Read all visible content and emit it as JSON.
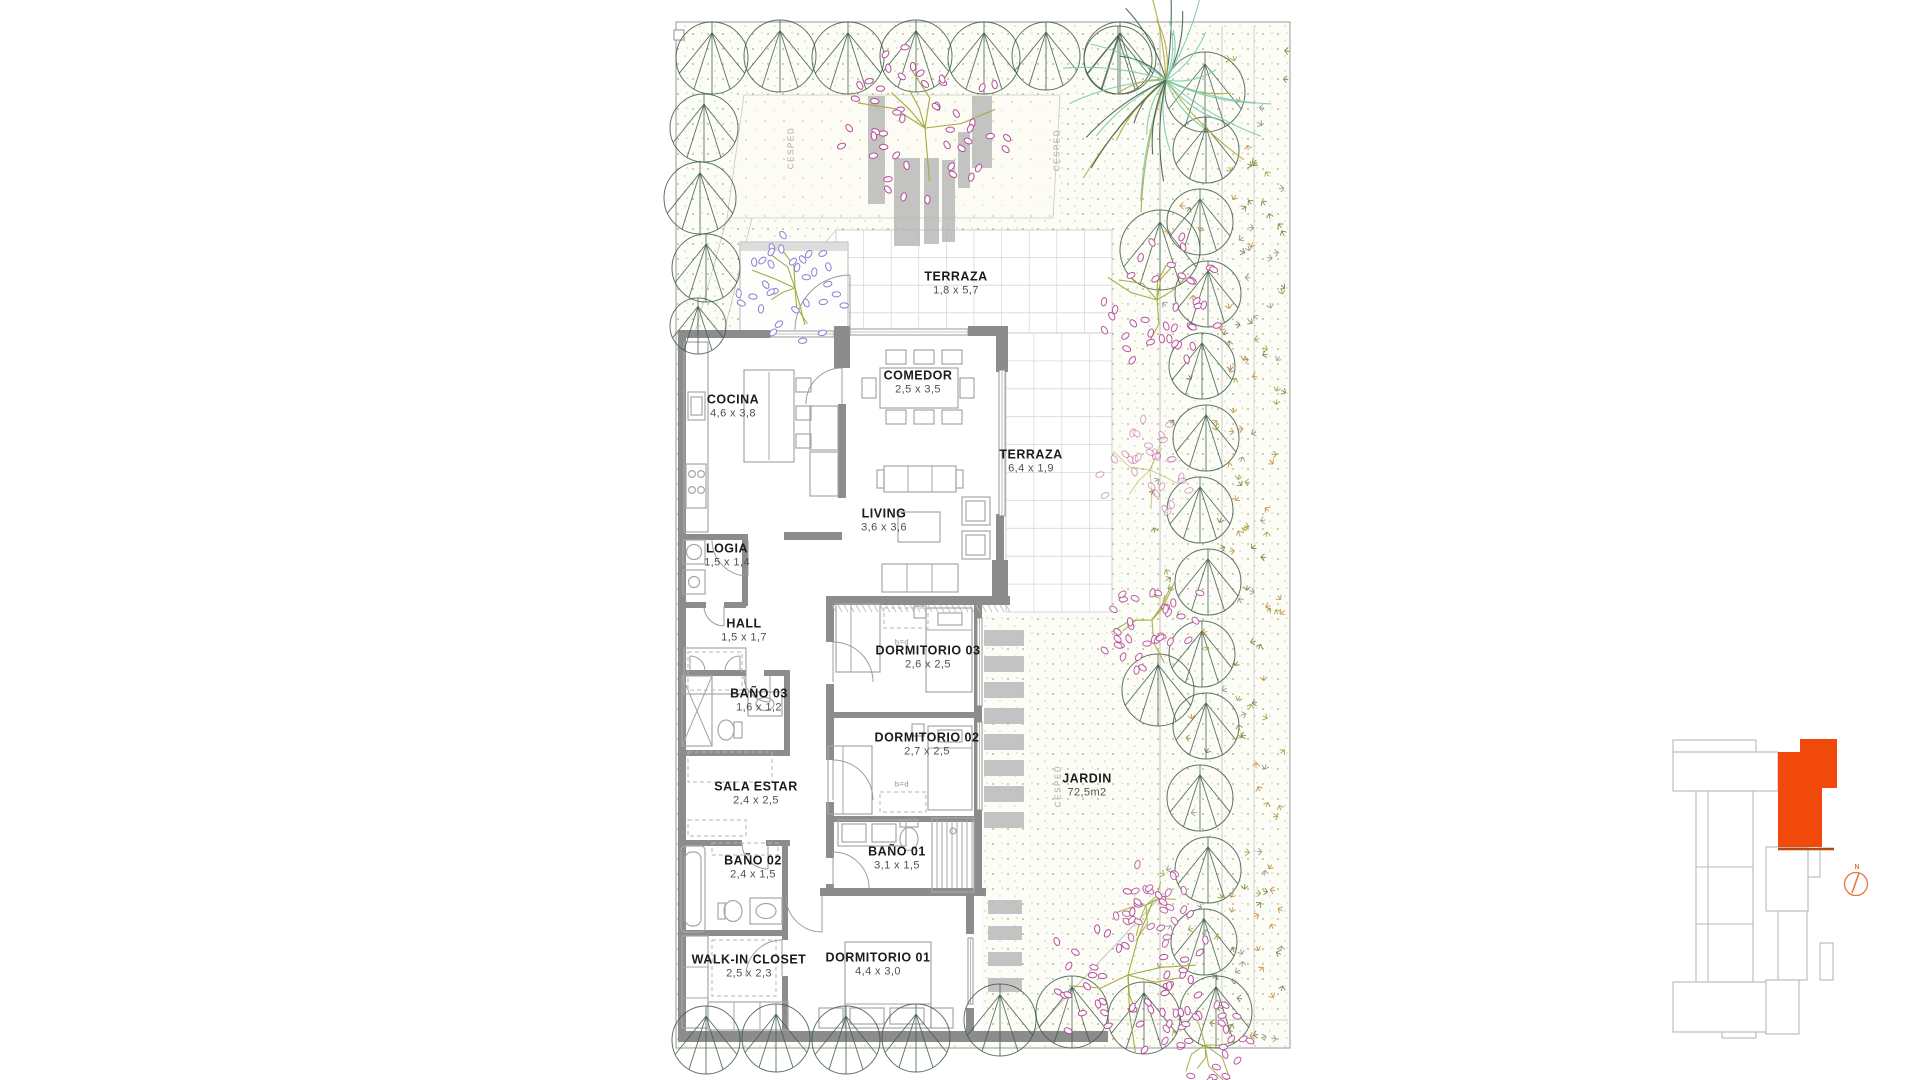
{
  "page": {
    "background": "#ffffff"
  },
  "plan": {
    "rooms": [
      {
        "name": "TERRAZA",
        "dims": "1,8 x 5,7",
        "x": 956,
        "y": 283
      },
      {
        "name": "COCINA",
        "dims": "4,6 x 3,8",
        "x": 733,
        "y": 406
      },
      {
        "name": "COMEDOR",
        "dims": "2,5 x 3,5",
        "x": 918,
        "y": 382
      },
      {
        "name": "TERRAZA",
        "dims": "6,4 x 1,9",
        "x": 1031,
        "y": 461
      },
      {
        "name": "LIVING",
        "dims": "3,6 x 3,6",
        "x": 884,
        "y": 520
      },
      {
        "name": "LOGIA",
        "dims": "1,5 x 1,4",
        "x": 727,
        "y": 555
      },
      {
        "name": "HALL",
        "dims": "1,5 x 1,7",
        "x": 744,
        "y": 630
      },
      {
        "name": "BAÑO 03",
        "dims": "1,6 x 1,2",
        "x": 759,
        "y": 700
      },
      {
        "name": "DORMITORIO 03",
        "dims": "2,6 x 2,5",
        "x": 928,
        "y": 657
      },
      {
        "name": "DORMITORIO 02",
        "dims": "2,7 x 2,5",
        "x": 927,
        "y": 744
      },
      {
        "name": "SALA ESTAR",
        "dims": "2,4 x 2,5",
        "x": 756,
        "y": 793
      },
      {
        "name": "BAÑO 02",
        "dims": "2,4 x 1,5",
        "x": 753,
        "y": 867
      },
      {
        "name": "BAÑO 01",
        "dims": "3,1 x 1,5",
        "x": 897,
        "y": 858
      },
      {
        "name": "JARDIN",
        "dims": "72,5m2",
        "x": 1087,
        "y": 785
      },
      {
        "name": "WALK-IN CLOSET",
        "dims": "2,5 x 2,3",
        "x": 749,
        "y": 966
      },
      {
        "name": "DORMITORIO 01",
        "dims": "4,4 x 3,0",
        "x": 878,
        "y": 964
      }
    ],
    "ground_labels": [
      {
        "text": "CESPED",
        "x": 791,
        "y": 148
      },
      {
        "text": "CESPED",
        "x": 1057,
        "y": 150
      },
      {
        "text": "CESPED",
        "x": 1058,
        "y": 786
      }
    ],
    "furniture_markers": [
      {
        "text": "b=d",
        "x": 902,
        "y": 642
      },
      {
        "text": "b=d",
        "x": 902,
        "y": 784
      }
    ]
  },
  "keyplan": {
    "unit_color": "#F1490B",
    "unit_underline_color": "#B5490F",
    "outline_color": "#B9B9B9",
    "compass": {
      "label": "N",
      "color": "#E4763B"
    }
  },
  "palette": {
    "wall": "#8C8C8C",
    "furniture_line": "#A6A6A6",
    "dashed_line": "#B5B5B5",
    "tile_line": "#D8D8D8",
    "tile_border": "#C4C4C4",
    "boundary": "#A9A9A9",
    "door": "#9C9C9C",
    "stone": "#BDBDBD",
    "planter": "#B4B4B4",
    "tree": "#3E5C4B",
    "branch": "#A3AD3F",
    "petal_pink": "#B44D98",
    "petal_purple": "#8781D1",
    "palm_mint": "#7CC9AD",
    "palm_dark": "#3C604D",
    "palm_olive": "#AFA63A",
    "speckle_olive": "#B3A96A",
    "speckle_gray": "#C6C6C6",
    "scatter_colors": [
      "#9C9A3A",
      "#C08A36",
      "#8F8F8F",
      "#6F7D3A"
    ]
  }
}
